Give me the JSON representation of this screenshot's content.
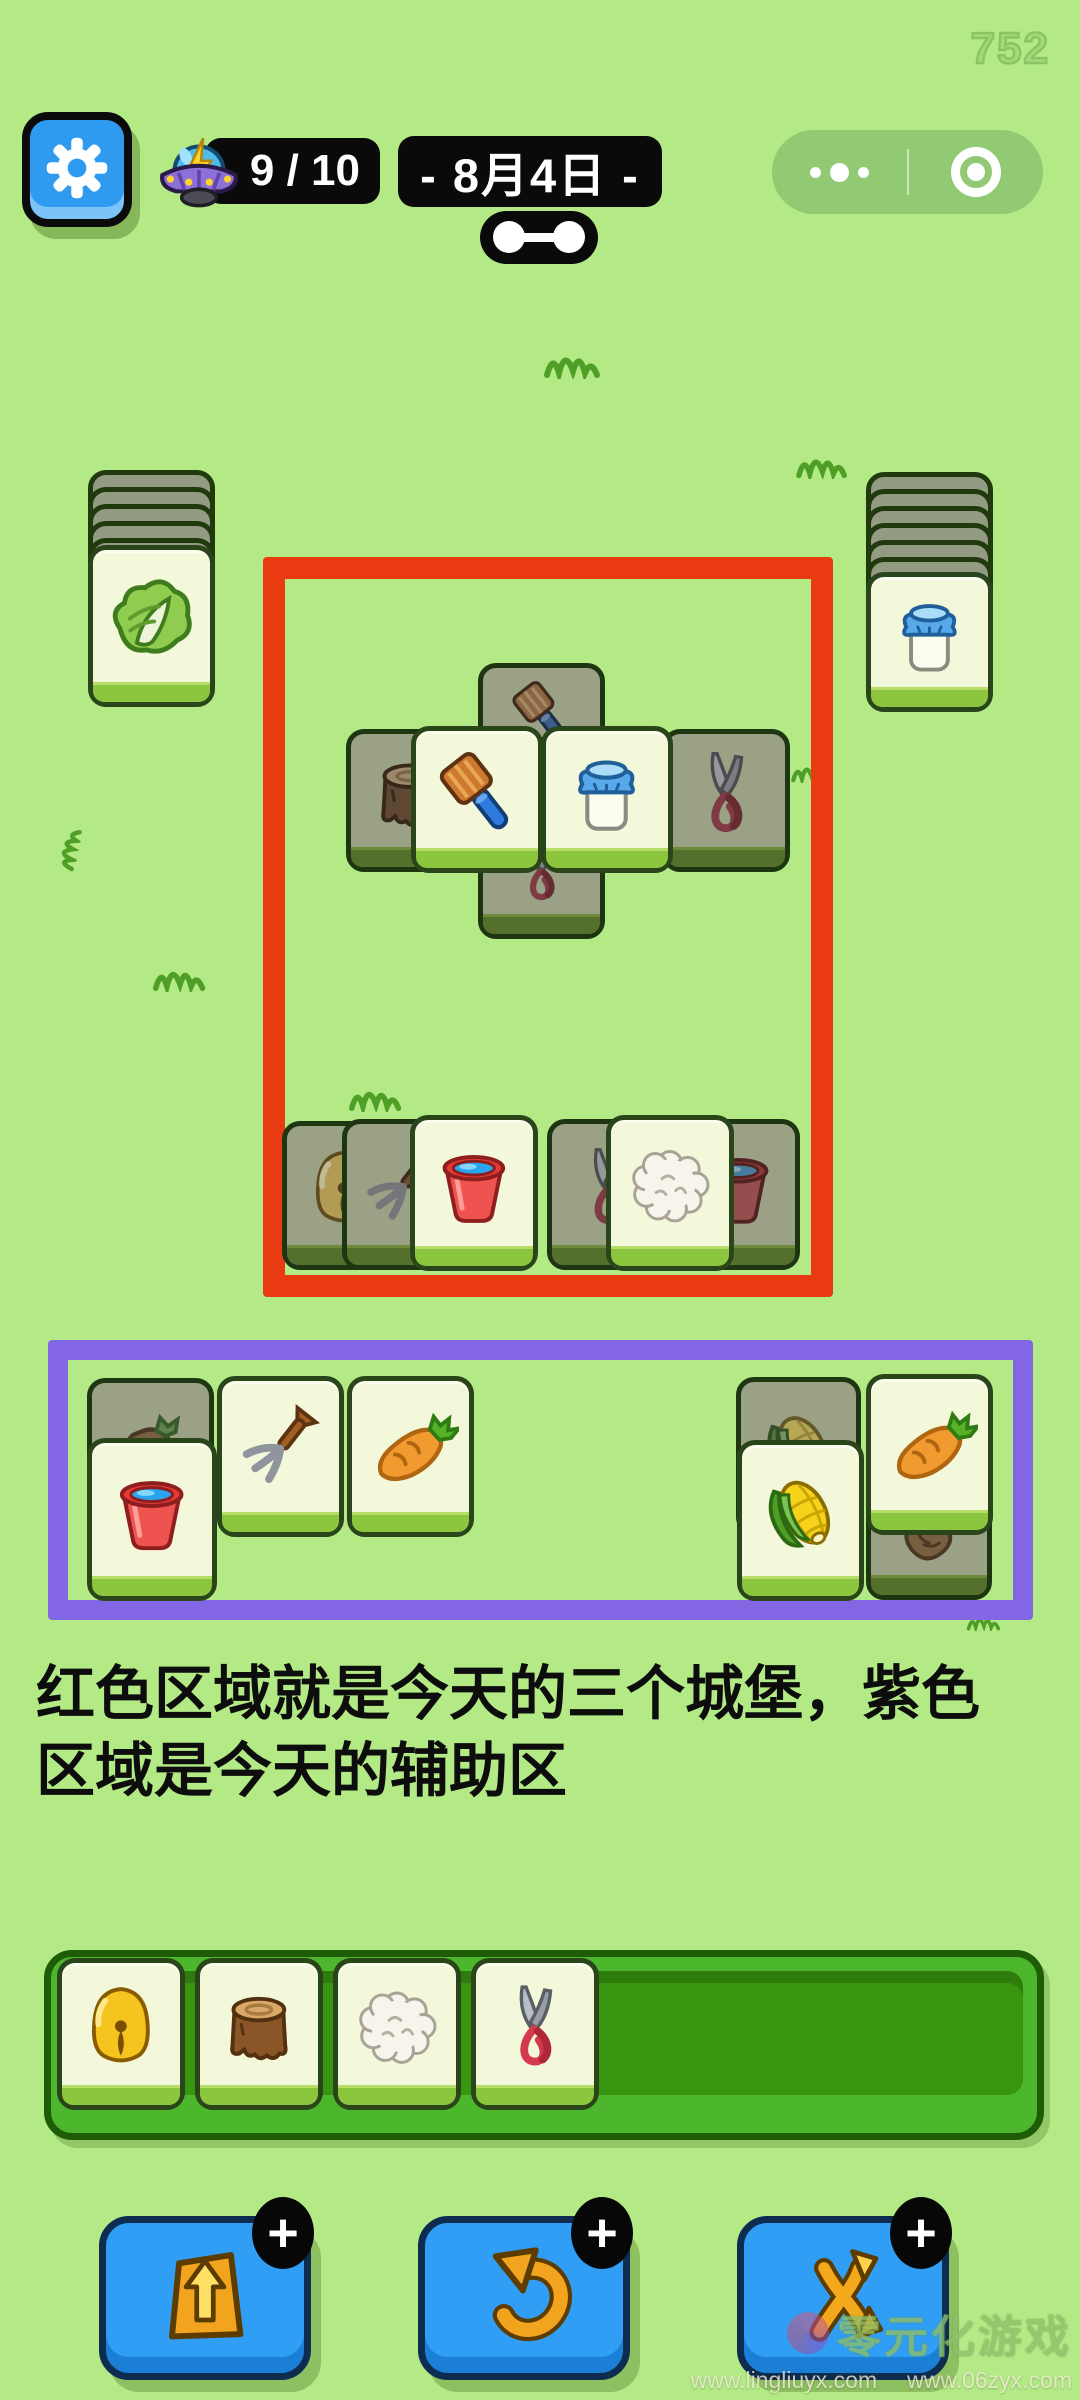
{
  "hud": {
    "round_counter": "752",
    "energy": {
      "icon": "ufo-icon",
      "value": "9 / 10"
    },
    "date_label": "- 8月4日 -",
    "capsule": {
      "more_icon": "ellipsis-icon",
      "exit_icon": "record-icon"
    }
  },
  "board": {
    "left_stack": {
      "x": 88,
      "y": 470,
      "backs": 5,
      "face": "cabbage",
      "face_y": 545,
      "face_h": 162
    },
    "right_stack": {
      "x": 866,
      "y": 472,
      "backs": 6,
      "face": "milk",
      "face_y": 572,
      "face_h": 140
    },
    "castle_zone": {
      "x": 263,
      "y": 557,
      "w": 570,
      "h": 740,
      "border": 22,
      "color": "#ea3a11"
    },
    "aux_zone": {
      "x": 48,
      "y": 1340,
      "w": 985,
      "h": 280,
      "border": 20,
      "color": "#8266e4"
    },
    "castle_tiles": [
      {
        "icon": "brush",
        "state": "covered",
        "x": 478,
        "y": 663,
        "w": 127,
        "h": 207,
        "z": 1,
        "icon_pos": "top"
      },
      {
        "icon": "shears",
        "state": "covered",
        "x": 478,
        "y": 737,
        "w": 127,
        "h": 202,
        "z": 1,
        "icon_pos": "bottom"
      },
      {
        "icon": "stump",
        "state": "covered",
        "x": 346,
        "y": 729,
        "w": 128,
        "h": 143,
        "z": 2
      },
      {
        "icon": "shears",
        "state": "covered",
        "x": 662,
        "y": 729,
        "w": 128,
        "h": 143,
        "z": 2
      },
      {
        "icon": "brush",
        "state": "face",
        "x": 411,
        "y": 726,
        "w": 132,
        "h": 147,
        "z": 3
      },
      {
        "icon": "milk",
        "state": "face",
        "x": 541,
        "y": 726,
        "w": 132,
        "h": 147,
        "z": 3
      },
      {
        "icon": "bell",
        "state": "covered",
        "x": 282,
        "y": 1121,
        "w": 122,
        "h": 149,
        "z": 1
      },
      {
        "icon": "pitchfork",
        "state": "covered",
        "x": 342,
        "y": 1119,
        "w": 122,
        "h": 151,
        "z": 2
      },
      {
        "icon": "bucket",
        "state": "face",
        "x": 410,
        "y": 1115,
        "w": 128,
        "h": 156,
        "z": 3
      },
      {
        "icon": "shears",
        "state": "covered",
        "x": 547,
        "y": 1119,
        "w": 122,
        "h": 151,
        "z": 2
      },
      {
        "icon": "bucket",
        "state": "covered",
        "x": 676,
        "y": 1119,
        "w": 124,
        "h": 151,
        "z": 1
      },
      {
        "icon": "wool",
        "state": "face",
        "x": 606,
        "y": 1115,
        "w": 128,
        "h": 156,
        "z": 3
      }
    ],
    "aux_tiles": [
      {
        "icon": "turnip",
        "state": "covered",
        "x": 87,
        "y": 1378,
        "w": 127,
        "h": 158,
        "z": 1
      },
      {
        "icon": "bucket",
        "state": "face",
        "x": 87,
        "y": 1438,
        "w": 130,
        "h": 163,
        "z": 2
      },
      {
        "icon": "pitchfork",
        "state": "face",
        "x": 217,
        "y": 1376,
        "w": 127,
        "h": 161,
        "z": 2
      },
      {
        "icon": "carrot",
        "state": "face",
        "x": 347,
        "y": 1376,
        "w": 127,
        "h": 161,
        "z": 2
      },
      {
        "icon": "corn",
        "state": "covered",
        "x": 736,
        "y": 1377,
        "w": 125,
        "h": 158,
        "z": 1
      },
      {
        "icon": "corn",
        "state": "face",
        "x": 737,
        "y": 1440,
        "w": 127,
        "h": 161,
        "z": 2
      },
      {
        "icon": "carrot",
        "state": "face",
        "x": 866,
        "y": 1374,
        "w": 127,
        "h": 161,
        "z": 3
      },
      {
        "icon": "turnip",
        "state": "covered",
        "x": 866,
        "y": 1478,
        "w": 126,
        "h": 122,
        "z": 1
      }
    ],
    "tray": {
      "x": 44,
      "y": 1950,
      "w": 1000,
      "h": 190,
      "tiles": [
        "bell",
        "stump",
        "wool",
        "shears"
      ]
    }
  },
  "caption": {
    "line1": "红色区域就是今天的三个城堡，紫色",
    "line2": "区域是今天的辅助区"
  },
  "toolbar": [
    {
      "name": "moveout",
      "icon": "moveout-icon",
      "badge": "+"
    },
    {
      "name": "undo",
      "icon": "undo-icon",
      "badge": "+"
    },
    {
      "name": "shuffle",
      "icon": "shuffle-icon",
      "badge": "+"
    }
  ],
  "watermark": {
    "title": "零元化游戏",
    "url1": "www.lingliuyx.com",
    "url2": "www.06zyx.com"
  },
  "colors": {
    "background": "#b3ea86",
    "castle_outline": "#ea3a11",
    "aux_outline": "#8266e4",
    "tile_face": "#f4f8da",
    "tile_covered": "#9aa184",
    "tray_green": "#4cb62c",
    "button_blue": "#2f9ef4",
    "pill_black": "#0a0a0a"
  }
}
